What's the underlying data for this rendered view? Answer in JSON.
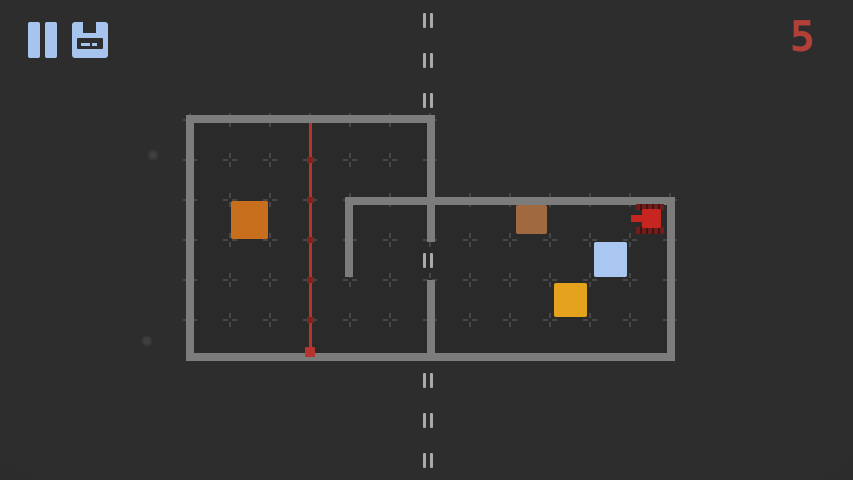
{
  "hud": {
    "counter": "5",
    "icons": {
      "pause": "pause-icon",
      "save": "save-icon"
    }
  },
  "colors": {
    "background": "#2d2d2d",
    "room_fill": "#2a2a2a",
    "wall": "#7c7c7c",
    "grid_mark": "#474747",
    "dash": "#aaaaaa",
    "hud_icon": "#a6c4ee",
    "counter": "#b04038",
    "trail": "#b5352e",
    "trail_node": "#7e2721",
    "tank_body": "#c6261f",
    "tank_tread": "#6f1f1b"
  },
  "level": {
    "rooms": [
      {
        "x": 186,
        "y": 115,
        "w": 249,
        "h": 246
      },
      {
        "x": 345,
        "y": 197,
        "w": 330,
        "h": 164
      }
    ],
    "walls": [
      {
        "x": 186,
        "y": 115,
        "w": 249,
        "h": 8
      },
      {
        "x": 186,
        "y": 115,
        "w": 8,
        "h": 246
      },
      {
        "x": 186,
        "y": 353,
        "w": 489,
        "h": 8
      },
      {
        "x": 427,
        "y": 115,
        "w": 8,
        "h": 127
      },
      {
        "x": 427,
        "y": 280,
        "w": 8,
        "h": 81
      },
      {
        "x": 345,
        "y": 197,
        "w": 330,
        "h": 8
      },
      {
        "x": 345,
        "y": 197,
        "w": 8,
        "h": 80
      },
      {
        "x": 667,
        "y": 197,
        "w": 8,
        "h": 164
      }
    ],
    "grid": {
      "spacing": 40,
      "offset_x": 30,
      "offset_y": 0
    },
    "center_dashes": {
      "x": 429,
      "groups_y": [
        20,
        60,
        100,
        260,
        380,
        420,
        460
      ]
    },
    "trail": {
      "x": 310,
      "y_top": 123,
      "y_bottom": 353,
      "nodes_y": [
        160,
        200,
        240,
        280,
        320
      ],
      "end_dot": {
        "x": 305,
        "y": 347,
        "size": 10
      }
    },
    "boxes": [
      {
        "name": "orange-box",
        "x": 231,
        "y": 201,
        "w": 37,
        "h": 38,
        "color": "#c86f1d"
      },
      {
        "name": "brown-box",
        "x": 516,
        "y": 205,
        "w": 31,
        "h": 29,
        "color": "#a0693f"
      },
      {
        "name": "blue-box",
        "x": 594,
        "y": 242,
        "w": 33,
        "h": 35,
        "color": "#a9c7f0"
      },
      {
        "name": "yellow-box",
        "x": 554,
        "y": 283,
        "w": 33,
        "h": 34,
        "color": "#e5a31d"
      }
    ],
    "tank": {
      "facing": "left",
      "tread_top": {
        "x": 636,
        "y": 204,
        "w": 28,
        "h": 6
      },
      "barrel": {
        "x": 631,
        "y": 215,
        "w": 14,
        "h": 7
      },
      "body": {
        "x": 642,
        "y": 209,
        "w": 19,
        "h": 19
      },
      "tread_bottom": {
        "x": 636,
        "y": 227,
        "w": 28,
        "h": 7
      }
    },
    "particles": [
      {
        "x": 149,
        "y": 151,
        "size": 8
      },
      {
        "x": 143,
        "y": 337,
        "size": 8
      }
    ]
  }
}
